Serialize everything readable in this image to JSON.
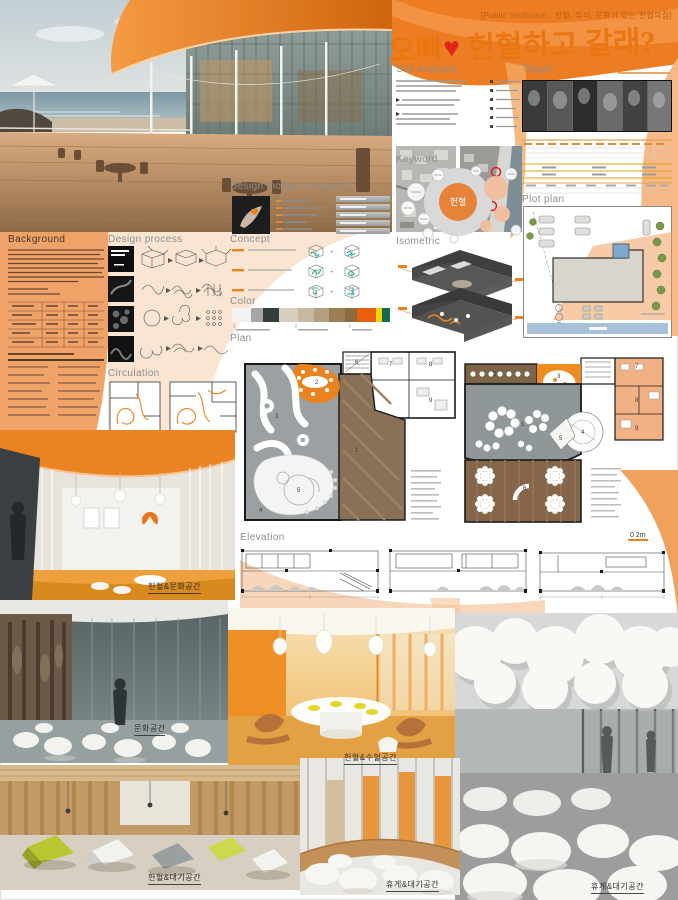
{
  "header": {
    "subtitle": "[Public Institution : 헌혈, 휴식, 문화가 있는 헌혈의집]",
    "title_part1": "오빠",
    "heart": "♥",
    "title_part2": "헌혈하고 갈래?"
  },
  "sections": {
    "site_analysis": "Site analysis",
    "target": "Target",
    "keyword": "Keyword",
    "isometric": "Isometric",
    "plot_plan": "Plot plan",
    "design_motive": "Design motive & keyword",
    "concept": "Concept",
    "color": "Color",
    "background": "Background",
    "design_process": "Design process",
    "circulation": "Circulation",
    "plan": "Plan",
    "elevation": "Elevation"
  },
  "keyword_diagram": {
    "center_label": "헌혈"
  },
  "color_palette": {
    "swatches": [
      {
        "hex": "#f3f2f0",
        "w": "5"
      },
      {
        "hex": "#a6a6a4",
        "w": "3"
      },
      {
        "hex": "#333f3a",
        "w": "4"
      },
      {
        "hex": "#d7cebf",
        "w": "5"
      },
      {
        "hex": "#c7b99f",
        "w": "4"
      },
      {
        "hex": "#b29f80",
        "w": "4"
      },
      {
        "hex": "#9c8055",
        "w": "4"
      },
      {
        "hex": "#8a6c3f",
        "w": "3"
      },
      {
        "hex": "#e95f0e",
        "w": "5"
      },
      {
        "hex": "#f3d501",
        "w": "1.6"
      },
      {
        "hex": "#17694f",
        "w": "2"
      }
    ]
  },
  "plan1": {
    "rooms": [
      "1",
      "2",
      "3",
      "4",
      "5",
      "6",
      "7",
      "8",
      "9"
    ]
  },
  "plan2": {
    "rooms": [
      "1",
      "2",
      "3",
      "4",
      "5",
      "6",
      "7",
      "8",
      "9"
    ]
  },
  "scale_labels": {
    "plan": "0  2m"
  },
  "renderings": [
    {
      "caption": "헌혈&문화공간"
    },
    {
      "caption": "문화공간"
    },
    {
      "caption": "헌혈&수혈공간"
    },
    {
      "caption": "휴게&대기공간"
    },
    {
      "caption": "헌혈&대기공간"
    },
    {
      "caption": "휴게&대기공간"
    }
  ],
  "accent": {
    "orange": "#ec7c1e",
    "heart_red": "#e2231a",
    "teal": "#18b29b"
  }
}
